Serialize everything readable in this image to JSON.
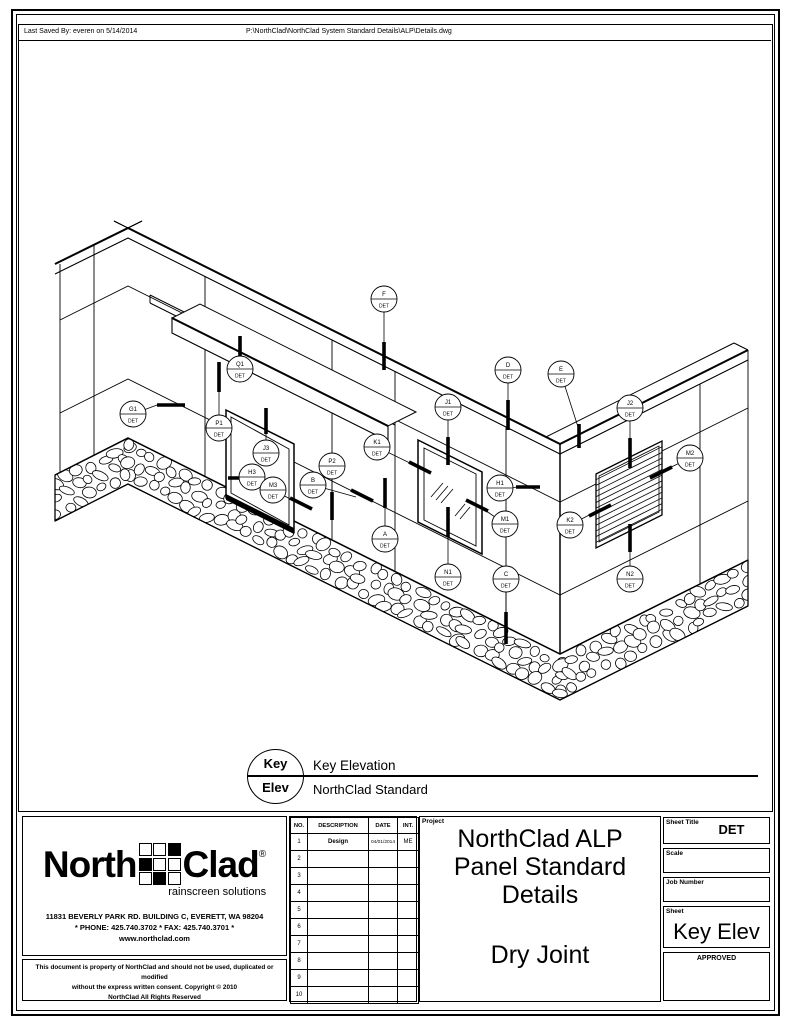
{
  "header": {
    "last_saved": "Last Saved By: everen on 5/14/2014",
    "file_path": "P:\\NorthClad\\NorthClad System Standard Details\\ALP\\Details.dwg"
  },
  "drawing": {
    "callout_suffix": "DET",
    "callouts": [
      {
        "label": "F",
        "x": 384,
        "y": 299,
        "leader": [
          384,
          342
        ],
        "tick": [
          384,
          342,
          384,
          370
        ]
      },
      {
        "label": "Q1",
        "x": 240,
        "y": 369,
        "leader": [
          240,
          358
        ],
        "tick": [
          240,
          336,
          240,
          360
        ]
      },
      {
        "label": "G1",
        "x": 133,
        "y": 414,
        "leader": [
          157,
          405
        ],
        "tick": [
          157,
          405,
          185,
          405
        ]
      },
      {
        "label": "P1",
        "x": 219,
        "y": 428,
        "leader": [
          219,
          392
        ],
        "tick": [
          219,
          362,
          219,
          392
        ]
      },
      {
        "label": "J3",
        "x": 266,
        "y": 453,
        "leader": [
          266,
          434
        ],
        "tick": [
          266,
          408,
          266,
          434
        ]
      },
      {
        "label": "H3",
        "x": 252,
        "y": 477,
        "leader": [
          246,
          478
        ],
        "tick": [
          228,
          478,
          248,
          478
        ]
      },
      {
        "label": "M3",
        "x": 273,
        "y": 490,
        "leader": [
          296,
          502
        ],
        "tick": [
          290,
          498,
          312,
          509
        ]
      },
      {
        "label": "B",
        "x": 313,
        "y": 485,
        "leader": [
          356,
          497
        ],
        "tick": [
          351,
          490,
          373,
          501
        ]
      },
      {
        "label": "P2",
        "x": 332,
        "y": 466,
        "leader": [
          332,
          494
        ],
        "tick": [
          332,
          492,
          332,
          520
        ]
      },
      {
        "label": "K1",
        "x": 377,
        "y": 447,
        "leader": [
          414,
          465
        ],
        "tick": [
          409,
          462,
          431,
          473
        ]
      },
      {
        "label": "A",
        "x": 385,
        "y": 539,
        "leader": [
          385,
          506
        ],
        "tick": [
          385,
          478,
          385,
          508
        ]
      },
      {
        "label": "N1",
        "x": 448,
        "y": 577,
        "leader": [
          448,
          536
        ],
        "tick": [
          448,
          507,
          448,
          537
        ]
      },
      {
        "label": "C",
        "x": 506,
        "y": 579,
        "leader": [
          506,
          614
        ],
        "tick": [
          506,
          612,
          506,
          644
        ]
      },
      {
        "label": "D",
        "x": 508,
        "y": 370,
        "leader": [
          508,
          402
        ],
        "tick": [
          508,
          400,
          508,
          430
        ]
      },
      {
        "label": "E",
        "x": 561,
        "y": 374,
        "leader": [
          579,
          430
        ],
        "tick": [
          579,
          424,
          579,
          448
        ]
      },
      {
        "label": "J1",
        "x": 448,
        "y": 407,
        "leader": [
          448,
          440
        ],
        "tick": [
          448,
          437,
          448,
          465
        ]
      },
      {
        "label": "J2",
        "x": 630,
        "y": 408,
        "leader": [
          630,
          440
        ],
        "tick": [
          630,
          438,
          630,
          468
        ]
      },
      {
        "label": "M2",
        "x": 690,
        "y": 458,
        "leader": [
          663,
          471
        ],
        "tick": [
          650,
          478,
          672,
          467
        ]
      },
      {
        "label": "H1",
        "x": 500,
        "y": 488,
        "leader": [
          522,
          487
        ],
        "tick": [
          516,
          487,
          540,
          487
        ]
      },
      {
        "label": "M1",
        "x": 505,
        "y": 524,
        "leader": [
          482,
          508
        ],
        "tick": [
          466,
          500,
          488,
          511
        ]
      },
      {
        "label": "K2",
        "x": 570,
        "y": 525,
        "leader": [
          597,
          511
        ],
        "tick": [
          589,
          516,
          611,
          505
        ]
      },
      {
        "label": "N2",
        "x": 630,
        "y": 579,
        "leader": [
          630,
          548
        ],
        "tick": [
          630,
          524,
          630,
          552
        ]
      }
    ]
  },
  "key_note": {
    "symbol_top": "Key",
    "symbol_bottom": "Elev",
    "title": "Key Elevation",
    "subtitle": "NorthClad Standard"
  },
  "title_block": {
    "logo": {
      "north": "North",
      "clad": "Clad",
      "registered": "®",
      "tagline": "rainscreen solutions",
      "grid": [
        [
          0,
          0,
          1
        ],
        [
          1,
          0,
          0
        ],
        [
          0,
          1,
          0
        ]
      ]
    },
    "address": "11831 BEVERLY PARK RD. BUILDING C, EVERETT, WA 98204",
    "phone": "* PHONE: 425.740.3702 * FAX: 425.740.3701 *",
    "website": "www.northclad.com",
    "disclaimer": {
      "l1": "This document is property of NorthClad and should not be used, duplicated or modified",
      "l2": "without the express written consent.  Copyright © 2010",
      "l3": "NorthClad All Rights Reserved"
    },
    "revisions": {
      "headers": [
        "NO.",
        "DESCRIPTION",
        "DATE",
        "INT."
      ],
      "rows": [
        [
          "1",
          "Design",
          "04/01/2014",
          "ME"
        ],
        [
          "2",
          "",
          "",
          ""
        ],
        [
          "3",
          "",
          "",
          ""
        ],
        [
          "4",
          "",
          "",
          ""
        ],
        [
          "5",
          "",
          "",
          ""
        ],
        [
          "6",
          "",
          "",
          ""
        ],
        [
          "7",
          "",
          "",
          ""
        ],
        [
          "8",
          "",
          "",
          ""
        ],
        [
          "9",
          "",
          "",
          ""
        ],
        [
          "10",
          "",
          "",
          ""
        ]
      ]
    },
    "project": {
      "label": "Project",
      "l1": "NorthClad ALP",
      "l2": "Panel Standard",
      "l3": "Details",
      "l4": "Dry Joint"
    },
    "fields": {
      "sheet_title": {
        "label": "Sheet Title",
        "value": "DET"
      },
      "scale": {
        "label": "Scale",
        "value": ""
      },
      "job_number": {
        "label": "Job Number",
        "value": ""
      },
      "sheet": {
        "label": "Sheet",
        "value": "Key Elev"
      },
      "approved": {
        "label": "APPROVED",
        "value": ""
      }
    }
  }
}
